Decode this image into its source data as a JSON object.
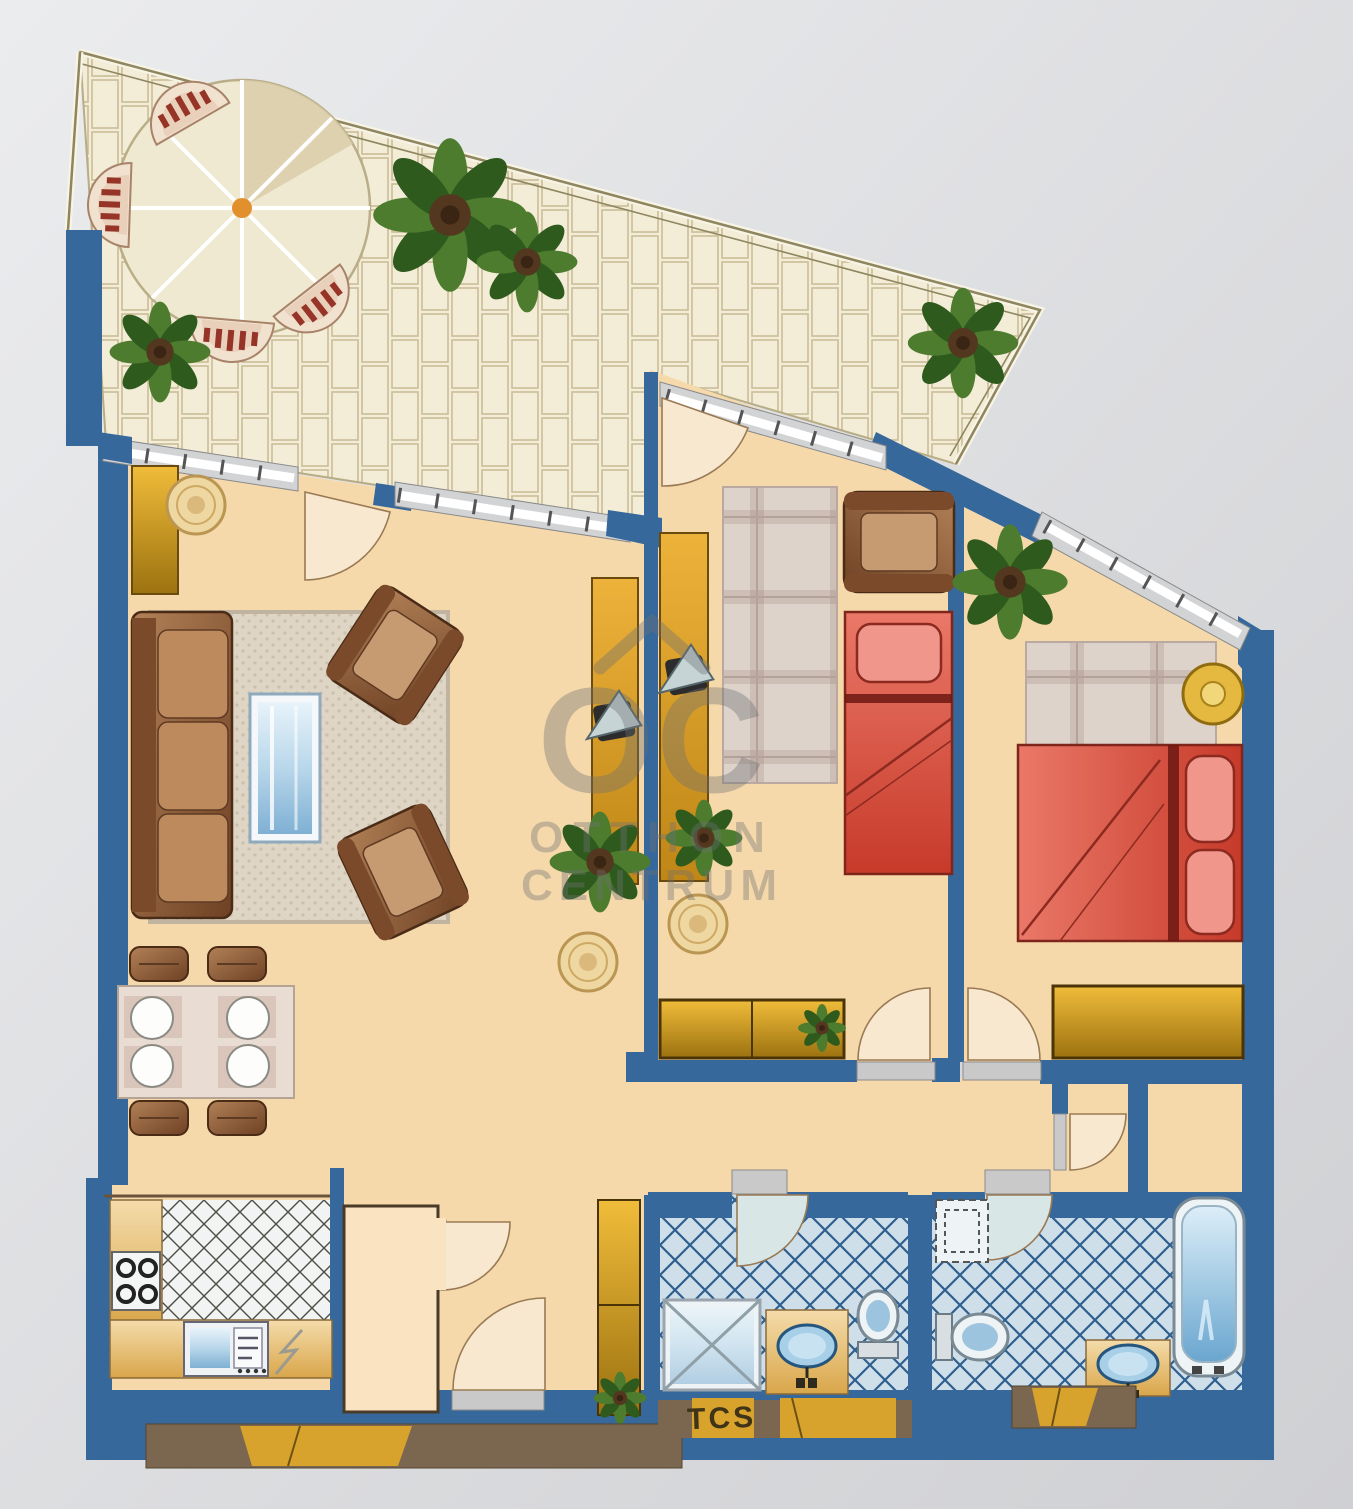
{
  "watermark": {
    "monogram": "OC",
    "line1": "OTTHON",
    "line2": "CENTRUM"
  },
  "labels": {
    "sill_label": "TCS"
  },
  "palette": {
    "paper1": "#eaebed",
    "paper2": "#d0d1d4",
    "wall": "#36689b",
    "floor": "#f6d9ab",
    "floorLight": "#f9e3c0",
    "terrace": "#f3edd7",
    "terraceLine": "#cabd97",
    "fence": "#8f855f",
    "band": "#d2d3d5",
    "glass": "#f4f5f6",
    "sill": "#c9c9c9",
    "rug": "#ded5c5",
    "rugDot": "#cbc0ad",
    "rugBorder": "#c0b4a0",
    "plaidBase": "#ded3cb",
    "plaidStripe": "#cdbeb6",
    "plaidDark": "#bfada6",
    "wood1": "#b28157",
    "wood2": "#6e4124",
    "woodTrim": "#4a2b16",
    "woodArm": "#7a4a2a",
    "cushion": "#bd8a5e",
    "gold1": "#f0bc3a",
    "gold2": "#9c7210",
    "goldTrim": "#6b4a10",
    "red1": "#ea7868",
    "red2": "#c73a2a",
    "redLight": "#f0968a",
    "redDark": "#7e251c",
    "redLine": "#6d1812",
    "tileBg": "#cfdfe9",
    "tileLine": "#2e5f8e",
    "ktileBg": "#f1f4f2",
    "ktileLine": "#4c4c46",
    "fixture": "#eef3f5",
    "fixtureEdge": "#7a8a94",
    "water": "#9cc4de",
    "counter1": "#f4dcab",
    "counter2": "#d9a64a",
    "leaf1": "#4d7c2f",
    "leaf2": "#2f5a1e",
    "soil": "#54371f",
    "chairCream": "#f0e2cf",
    "chairInner": "#e8d0ba",
    "chairStripe": "#963428",
    "umbrella": "#f0e9d1",
    "umbrellaShade": "#d9cdaa",
    "pole": "#e2902e",
    "fan": "#f7e8cf",
    "fanEdge": "#9a7a54",
    "bathFan": "#d9e6e6",
    "sillBrown": "#7b6650",
    "sillYellow": "#d8a32c",
    "ink": "#3f3318",
    "watermark": "#6f7173",
    "stool1": "#eed7a0",
    "stool2": "#bb9653",
    "stoolGold": "#e5b93f"
  }
}
